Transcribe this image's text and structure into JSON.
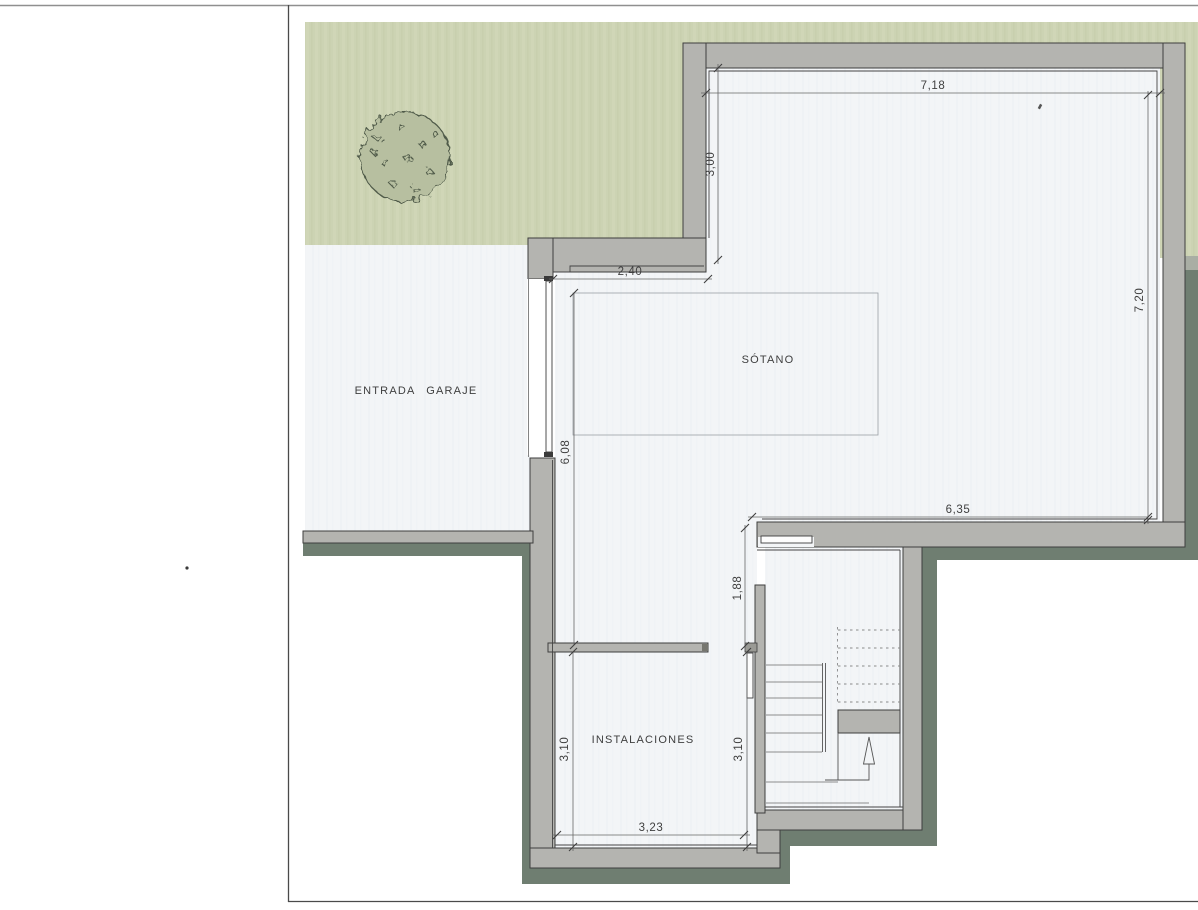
{
  "plan": {
    "title_note": "",
    "rooms": {
      "sotano": "SÓTANO",
      "garage": "ENTRADA GARAJE",
      "utilities": "INSTALACIONES"
    },
    "dimensions": {
      "top_width": "7,18",
      "left_upper_height": "3,00",
      "garage_link_width": "2,40",
      "right_height": "7,20",
      "hall_height": "6,08",
      "sotano_bottom_width": "6,35",
      "stair_door_height": "1,88",
      "utilities_height_left": "3,10",
      "utilities_height_right": "3,10",
      "utilities_width": "3,23"
    },
    "colors": {
      "grass": "#ccd3b3",
      "tree_fill": "#b7bfa0",
      "tree_line": "#4f5a48",
      "wall_gray": "#b4b4b0",
      "band_dark": "#6f7e71",
      "interior_white": "#f3f5f7",
      "line_dark": "#3e3e3e",
      "dim_line": "#666666",
      "page_border": "#4a4a4a"
    }
  }
}
